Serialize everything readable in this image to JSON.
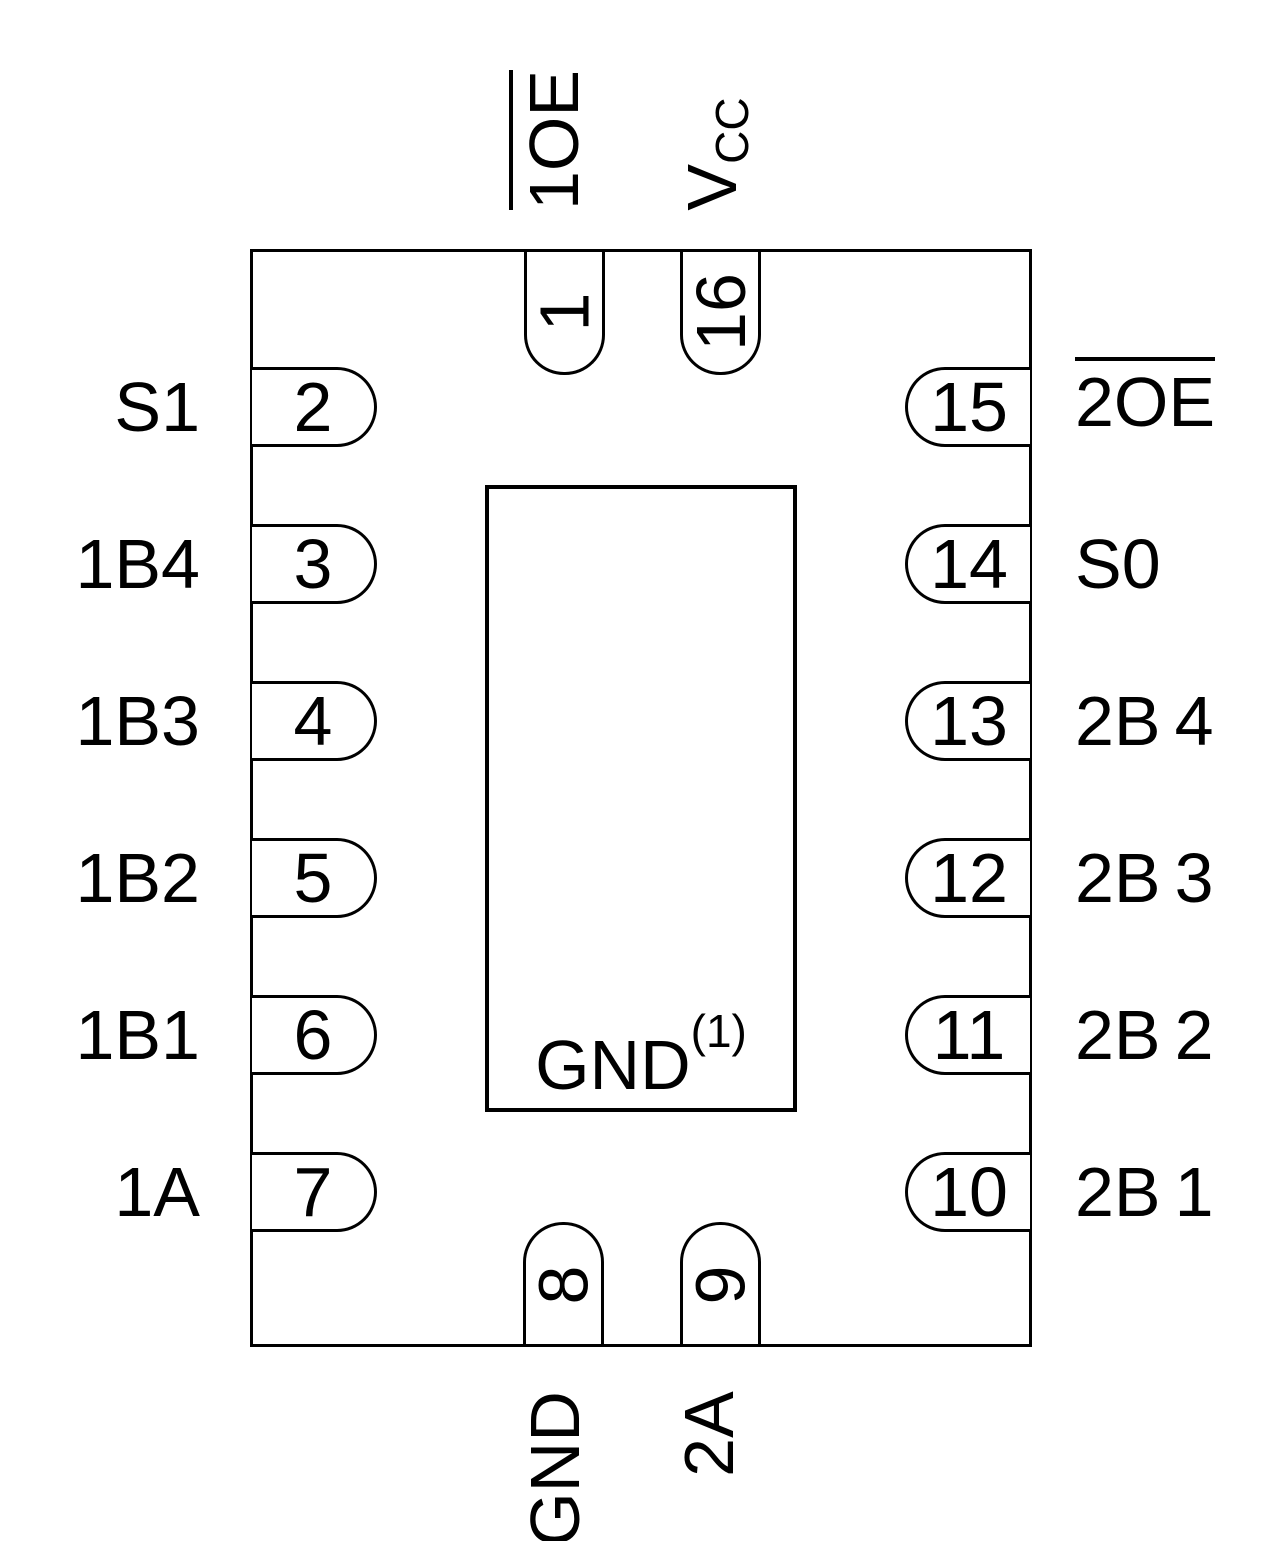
{
  "diagram": {
    "type": "ic-pinout-top-view",
    "package": {
      "pin_count": 16,
      "outline_color": "#000000",
      "background_color": "#ffffff"
    },
    "thermal_pad": {
      "label": "GND",
      "superscript": "(1)"
    },
    "pins": [
      {
        "number": "1",
        "name": "1OE",
        "side": "top",
        "overline": true,
        "display": "1OE"
      },
      {
        "number": "2",
        "name": "S1",
        "side": "left",
        "overline": false,
        "display": "S1"
      },
      {
        "number": "3",
        "name": "1B4",
        "side": "left",
        "overline": false,
        "display": "1B4"
      },
      {
        "number": "4",
        "name": "1B3",
        "side": "left",
        "overline": false,
        "display": "1B3"
      },
      {
        "number": "5",
        "name": "1B2",
        "side": "left",
        "overline": false,
        "display": "1B2"
      },
      {
        "number": "6",
        "name": "1B1",
        "side": "left",
        "overline": false,
        "display": "1B1"
      },
      {
        "number": "7",
        "name": "1A",
        "side": "left",
        "overline": false,
        "display": "1A"
      },
      {
        "number": "8",
        "name": "GND",
        "side": "bottom",
        "overline": false,
        "display": "GND"
      },
      {
        "number": "9",
        "name": "2A",
        "side": "bottom",
        "overline": false,
        "display": "2A"
      },
      {
        "number": "10",
        "name": "2B1",
        "side": "right",
        "overline": false,
        "display": "2B 1"
      },
      {
        "number": "11",
        "name": "2B2",
        "side": "right",
        "overline": false,
        "display": "2B 2"
      },
      {
        "number": "12",
        "name": "2B3",
        "side": "right",
        "overline": false,
        "display": "2B 3"
      },
      {
        "number": "13",
        "name": "2B4",
        "side": "right",
        "overline": false,
        "display": "2B 4"
      },
      {
        "number": "14",
        "name": "S0",
        "side": "right",
        "overline": false,
        "display": "S0"
      },
      {
        "number": "15",
        "name": "2OE",
        "side": "right",
        "overline": true,
        "display": "2OE"
      },
      {
        "number": "16",
        "name": "VCC",
        "side": "top",
        "overline": false,
        "display_base": "V",
        "display_subscript": "CC"
      }
    ]
  }
}
